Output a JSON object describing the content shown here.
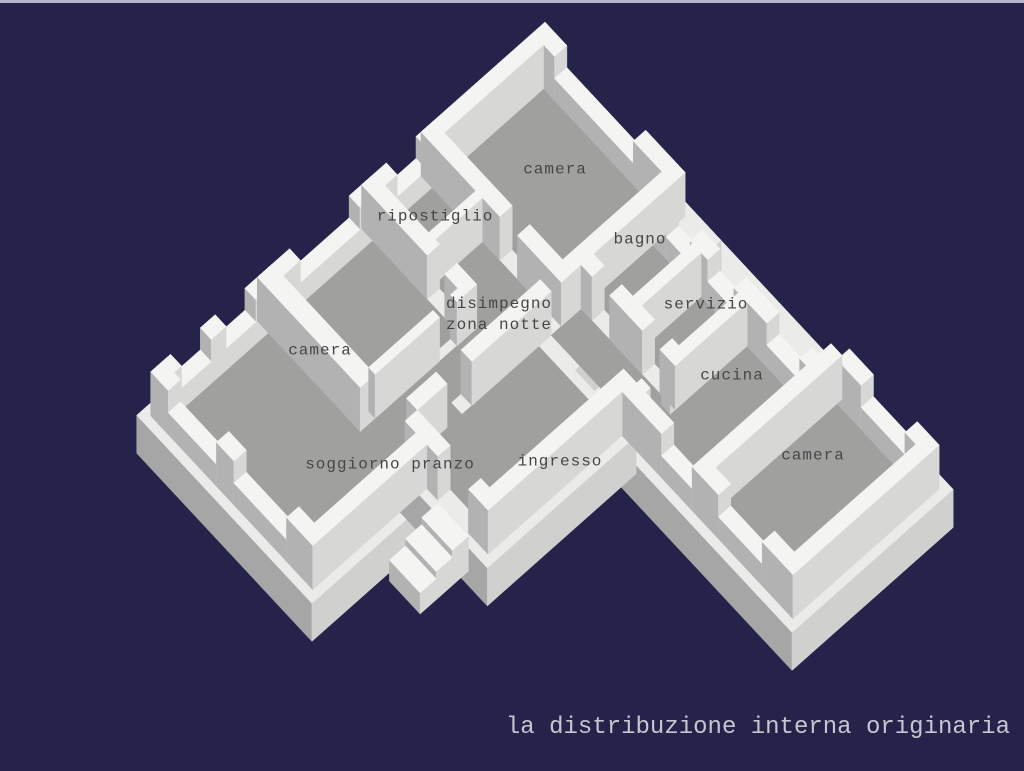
{
  "scene": {
    "background": "#252349",
    "top_border_color": "#b5b5cf"
  },
  "palette": {
    "wall_top": "#f4f4f2",
    "wall_face_sw": "#b2b2b2",
    "wall_face_se": "#d7d7d5",
    "floor": "#a0a09e",
    "plinth_top": "#ebebe9",
    "plinth_face_sw": "#a6a6a6",
    "plinth_face_se": "#d0d0ce",
    "label_color": "#464646"
  },
  "rooms": [
    {
      "label": "camera",
      "x": 555,
      "y": 170,
      "align": "center"
    },
    {
      "label": "ripostiglio",
      "x": 435,
      "y": 217,
      "align": "center"
    },
    {
      "label": "bagno",
      "x": 640,
      "y": 240,
      "align": "center"
    },
    {
      "label": "servizio",
      "x": 706,
      "y": 305,
      "align": "center"
    },
    {
      "label": "disimpegno\nzona notte",
      "x": 446,
      "y": 294,
      "align": "left"
    },
    {
      "label": "camera",
      "x": 320,
      "y": 351,
      "align": "center"
    },
    {
      "label": "cucina",
      "x": 732,
      "y": 376,
      "align": "center"
    },
    {
      "label": "camera",
      "x": 813,
      "y": 456,
      "align": "center"
    },
    {
      "label": "soggiorno pranzo",
      "x": 390,
      "y": 465,
      "align": "center"
    },
    {
      "label": "ingresso",
      "x": 560,
      "y": 462,
      "align": "center"
    }
  ],
  "caption": {
    "text": "la distribuzione interna originaria",
    "color": "#c6c6d0"
  }
}
